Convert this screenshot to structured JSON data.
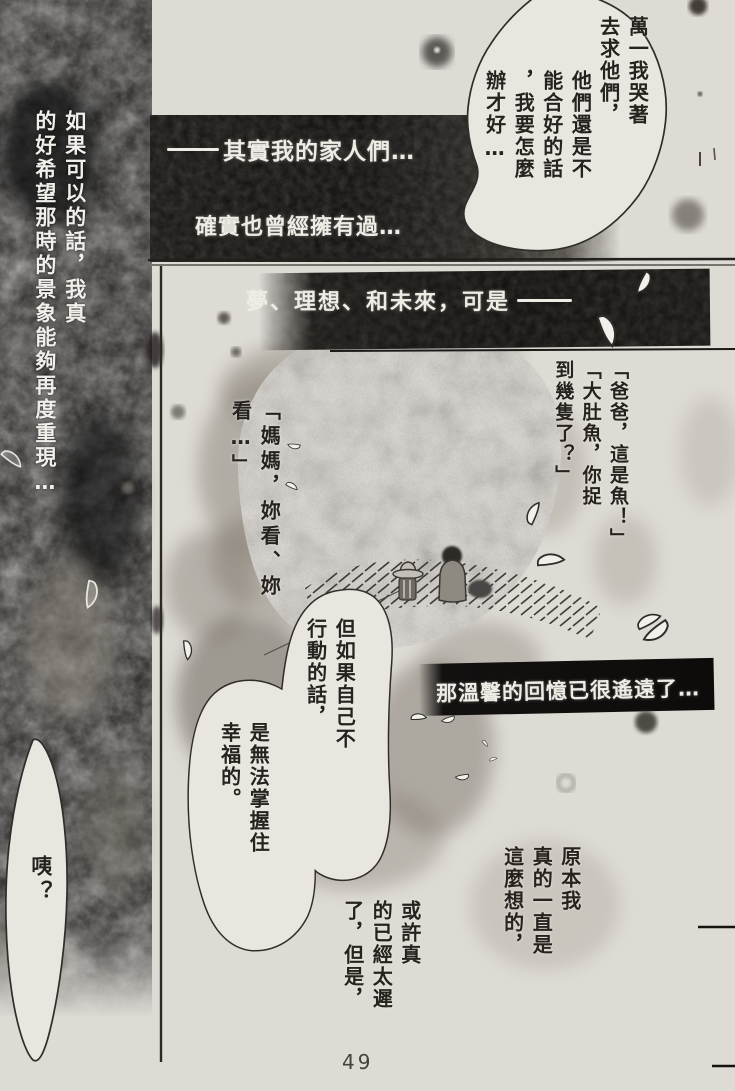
{
  "paper_color": "#dedbd5",
  "ink_color": "#26231f",
  "banner_text_color": "#efece5",
  "narration": {
    "wish": [
      "如果可以的話，我真",
      "的好希望那時的景象能夠再度重現…"
    ],
    "banner1": "其實我的家人們…",
    "banner2": "確實也曾經擁有過…",
    "banner3": "夢、理想、和未來，可是",
    "banner4": "那溫馨的回憶已很遙遠了…",
    "thought1": [
      "原本我",
      "真的一直是",
      "這麼想的，"
    ],
    "thought2": [
      "或許真",
      "的已經太遲",
      "了，但是，"
    ]
  },
  "dialogue": {
    "crying_a": [
      "萬一我哭著",
      "去求他們，"
    ],
    "crying_b": [
      "他們還是不",
      "能合好的話",
      "，我要怎麼",
      "辦才好…"
    ],
    "papa": [
      "「爸爸，這是魚！」",
      "「大肚魚，你捉",
      "到幾隻了？」"
    ],
    "mama": [
      "「媽媽，妳看、妳",
      "看…」"
    ],
    "action": [
      "但如果自己不",
      "行動的話，"
    ],
    "happiness": [
      "是無法掌握住",
      "幸福的。"
    ],
    "eh": "咦？"
  },
  "page_number": "49"
}
